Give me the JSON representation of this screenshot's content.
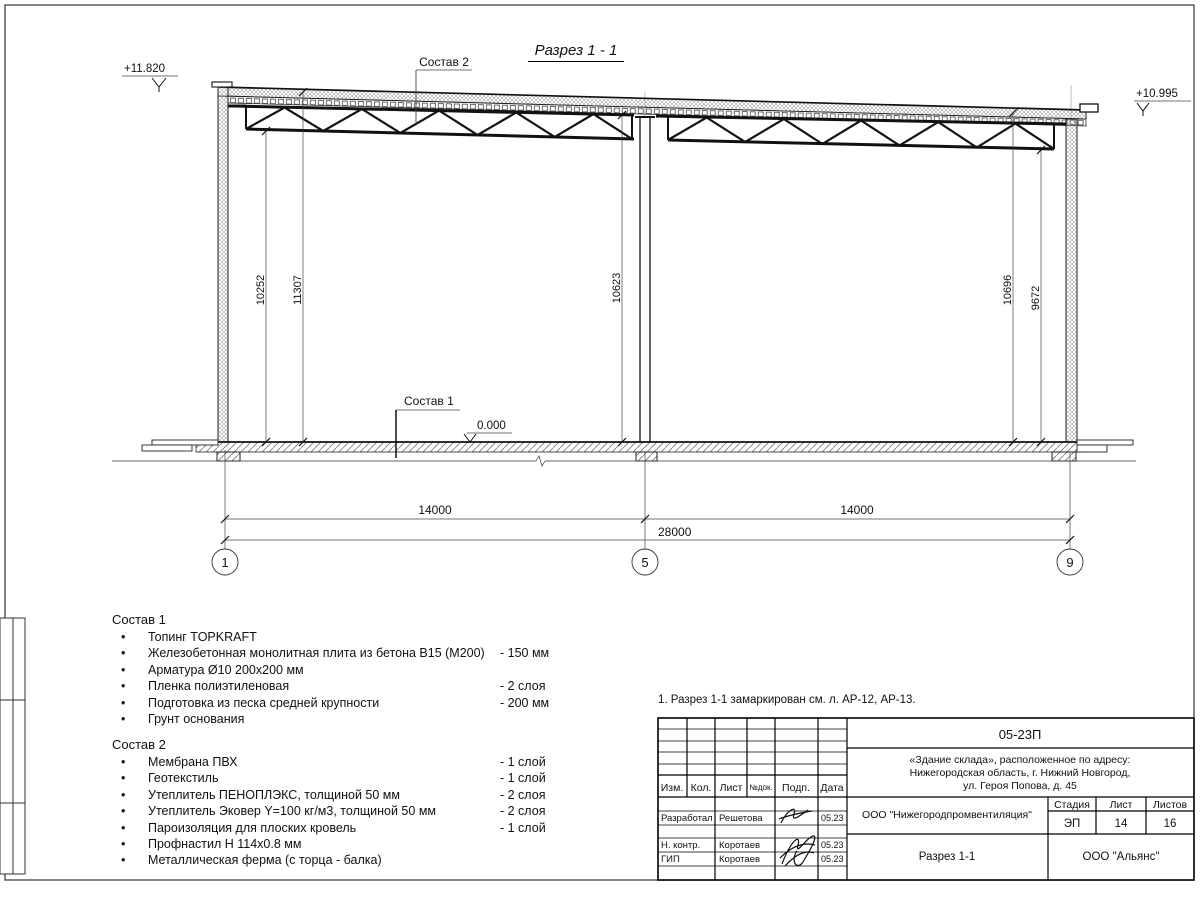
{
  "title": "Разрез 1 - 1",
  "note": "1. Разрез 1-1 замаркирован см. л. АР-12, АР-13.",
  "bullet": "•",
  "elevations": {
    "left": "+11.820",
    "right": "+10.995",
    "floor": "0.000"
  },
  "callouts": {
    "sostav1": "Состав 1",
    "sostav2": "Состав 2"
  },
  "dims": {
    "v_left_1": "10252",
    "v_left_2": "11307",
    "v_mid": "10623",
    "v_right_1": "10696",
    "v_right_2": "9672",
    "span_left": "14000",
    "span_right": "14000",
    "total": "28000"
  },
  "axes": {
    "a1": "1",
    "a2": "5",
    "a3": "9"
  },
  "sostav1": {
    "heading": "Состав 1",
    "items": [
      {
        "name": "Топинг TOPKRAFT",
        "value": ""
      },
      {
        "name": "Железобетонная монолитная плита из бетона В15 (М200)",
        "value": "- 150 мм"
      },
      {
        "name": "Арматура Ø10 200х200 мм",
        "value": ""
      },
      {
        "name": "Пленка полиэтиленовая",
        "value": "- 2 слоя"
      },
      {
        "name": "Подготовка из песка средней крупности",
        "value": "- 200 мм"
      },
      {
        "name": "Грунт основания",
        "value": ""
      }
    ]
  },
  "sostav2": {
    "heading": "Состав 2",
    "items": [
      {
        "name": "Мембрана ПВХ",
        "value": "- 1 слой"
      },
      {
        "name": "Геотекстиль",
        "value": "- 1 слой"
      },
      {
        "name": "Утеплитель ПЕНОПЛЭКС, толщиной 50 мм",
        "value": "- 2 слоя"
      },
      {
        "name": "Утеплитель Эковер Y=100 кг/м3, толщиной 50 мм",
        "value": "- 2 слоя"
      },
      {
        "name": "Пароизоляция для плоских кровель",
        "value": "- 1 слой"
      },
      {
        "name": "Профнастил Н 114х0.8 мм",
        "value": ""
      },
      {
        "name": "Металлическая ферма (с торца - балка)",
        "value": ""
      }
    ]
  },
  "titleblock": {
    "code": "05-23П",
    "object_lines": [
      "«Здание склада», расположенное по адресу:",
      "Нижегородская область, г. Нижний Новгород,",
      "ул. Героя Попова, д. 45"
    ],
    "cols": {
      "izm": "Изм.",
      "kol": "Кол.",
      "list": "Лист",
      "ndok": "№док.",
      "podp": "Подп.",
      "data": "Дата"
    },
    "rows": [
      {
        "role": "Разработал",
        "name": "Решетова",
        "date": "05.23"
      },
      {
        "role": "Н. контр.",
        "name": "Коротаев",
        "date": "05.23"
      },
      {
        "role": "ГИП",
        "name": "Коротаев",
        "date": "05.23"
      }
    ],
    "org": "ООО \"Нижегородпромвентиляция\"",
    "stage_label": "Стадия",
    "sheet_label": "Лист",
    "sheets_label": "Листов",
    "stage": "ЭП",
    "sheet": "14",
    "sheets": "16",
    "doc_title": "Разрез 1-1",
    "company": "ООО \"Альянс\""
  }
}
